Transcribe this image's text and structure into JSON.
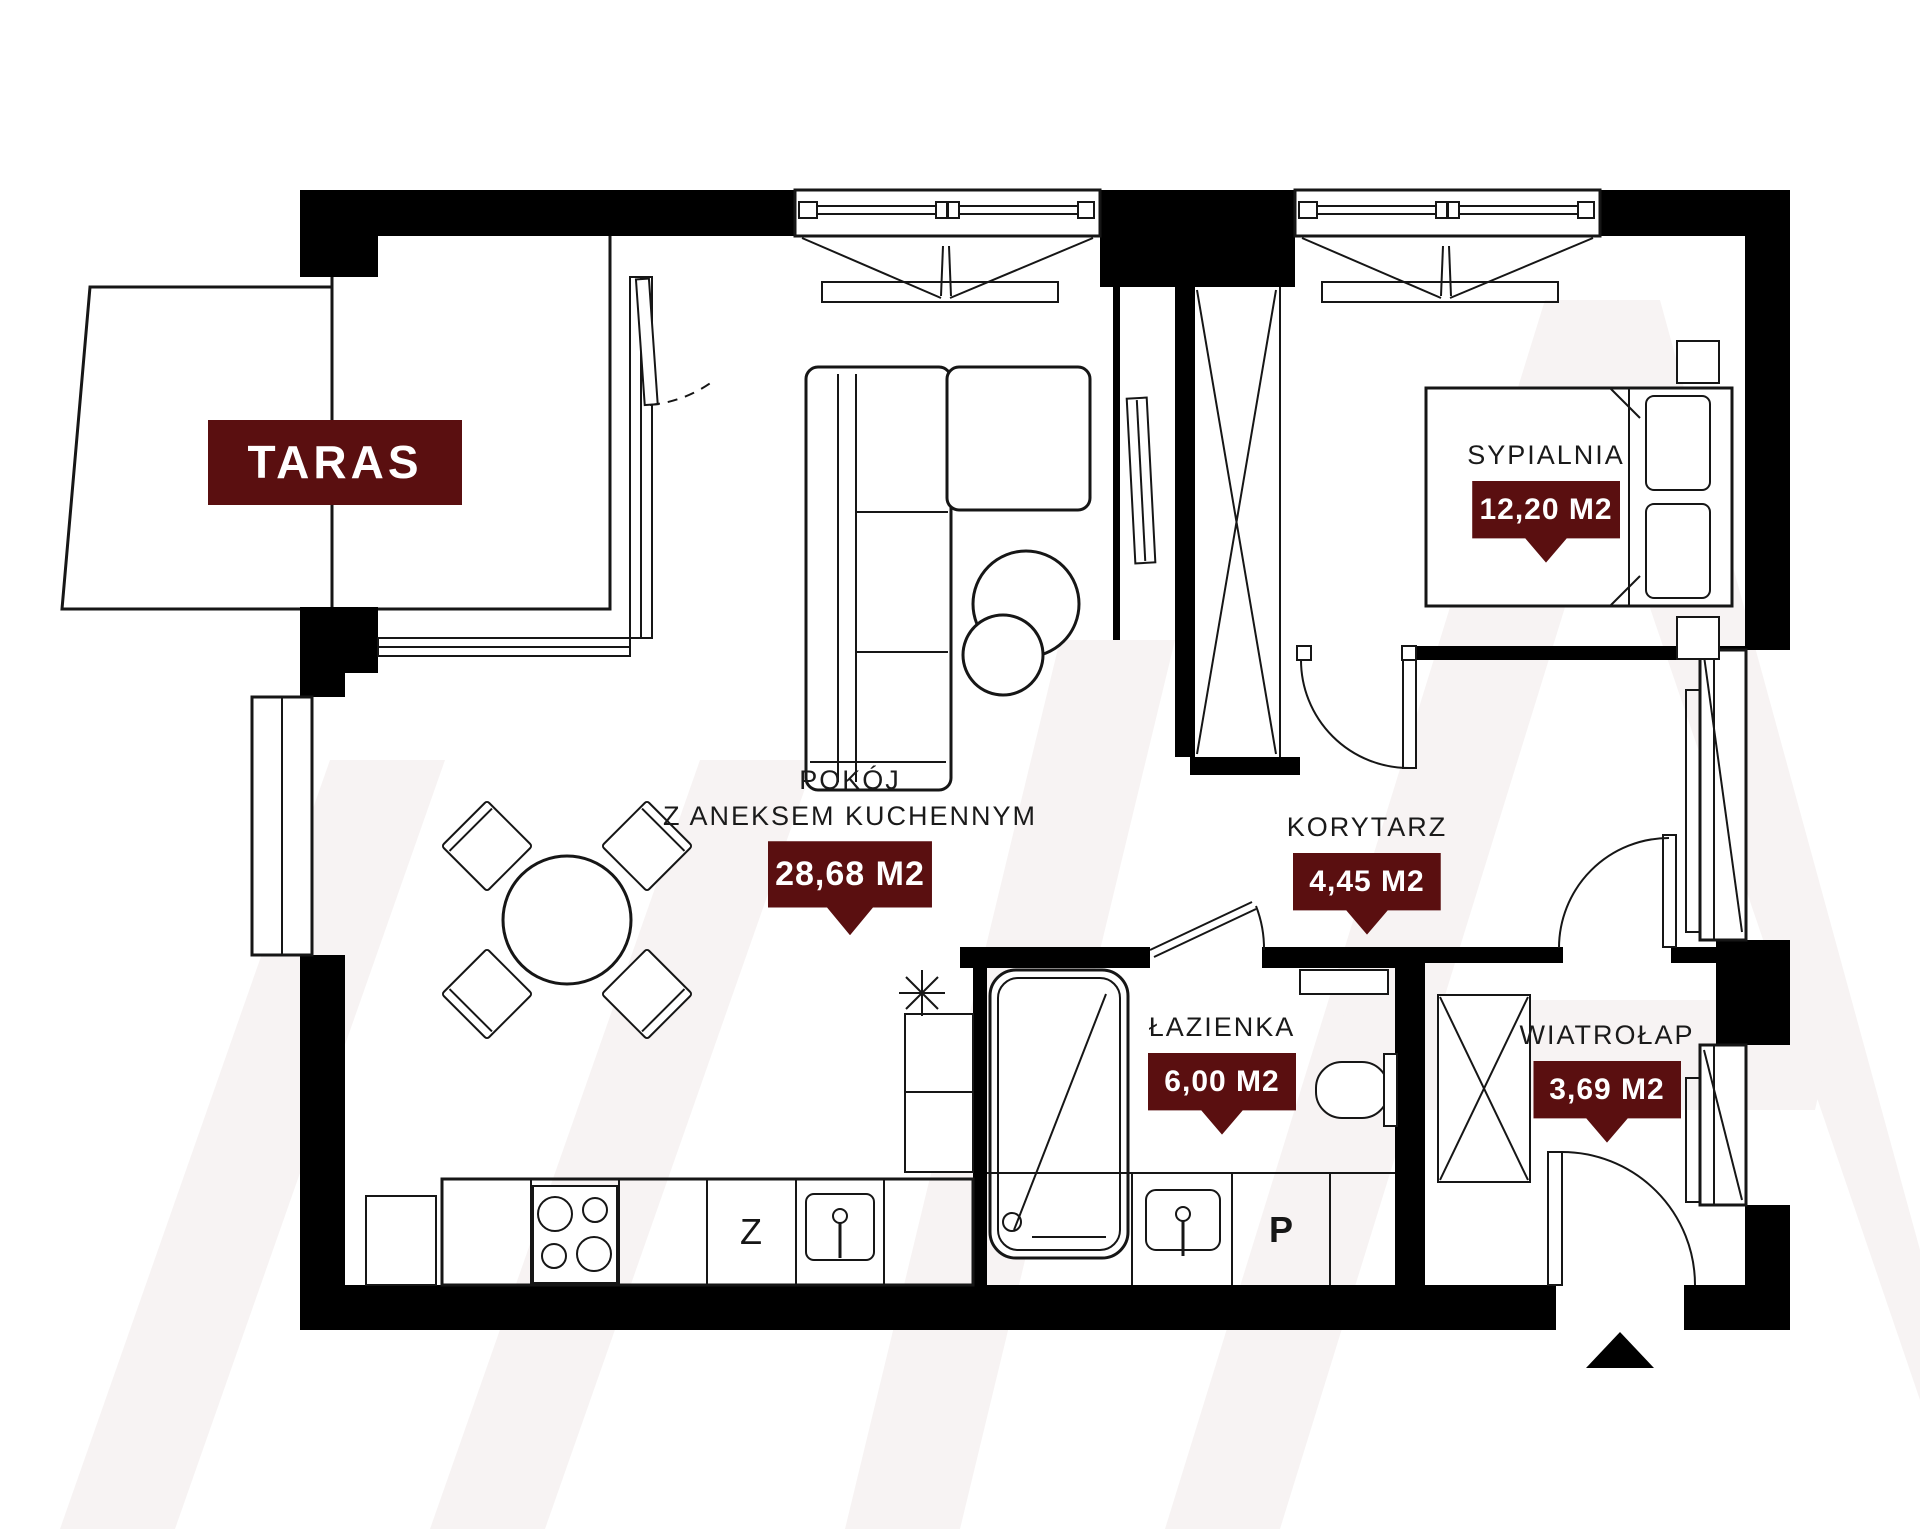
{
  "terrace": {
    "label": "TARAS"
  },
  "rooms": {
    "pokoj": {
      "line1": "POKÓJ",
      "line2": "Z ANEKSEM KUCHENNYM",
      "area": "28,68 M2"
    },
    "sypialnia": {
      "line1": "SYPIALNIA",
      "area": "12,20 M2"
    },
    "korytarz": {
      "line1": "KORYTARZ",
      "area": "4,45 M2"
    },
    "lazienka": {
      "line1": "ŁAZIENKA",
      "area": "6,00 M2"
    },
    "wiatrolap": {
      "line1": "WIATROŁAP",
      "area": "3,69 M2"
    }
  },
  "kitchen": {
    "dishwasher_label": "Z",
    "washer_label": "P"
  },
  "colors": {
    "accent": "#5a0f10",
    "wall": "#000000",
    "line": "#161616",
    "watermark": "#f7f3f3"
  }
}
